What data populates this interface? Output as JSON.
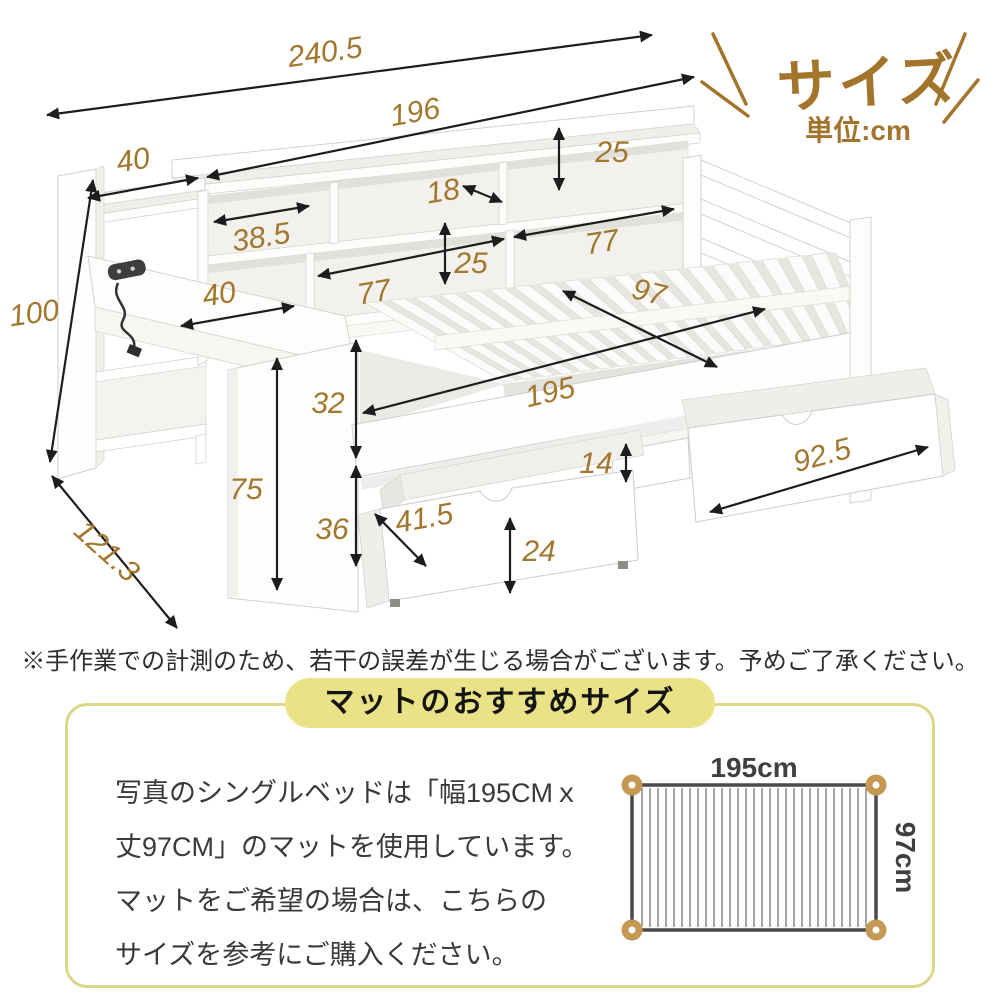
{
  "title": {
    "main": "サイズ",
    "unit": "単位:cm"
  },
  "disclaimer": "※手作業での計測のため、若干の誤差が生じる場合がございます。予めご了承ください。",
  "mat_box": {
    "header": "マットのおすすめサイズ",
    "lines": [
      "写真のシングルベッドは「幅195CMｘ",
      "丈97CM」のマットを使用しています。",
      "マットをご希望の場合は、こちらの",
      "サイズを参考にご購入ください。"
    ],
    "mat": {
      "width_label": "195cm",
      "height_label": "97cm"
    }
  },
  "dimensions": [
    {
      "value": "240.5",
      "lx": 325,
      "ly": 52,
      "rot": -8,
      "x1": 47,
      "y1": 115,
      "x2": 652,
      "y2": 35
    },
    {
      "value": "196",
      "lx": 415,
      "ly": 112,
      "rot": -10,
      "x1": 207,
      "y1": 177,
      "x2": 694,
      "y2": 77
    },
    {
      "value": "40",
      "lx": 133,
      "ly": 160,
      "rot": -9,
      "x1": 88,
      "y1": 198,
      "x2": 198,
      "y2": 178
    },
    {
      "value": "25",
      "lx": 612,
      "ly": 152,
      "rot": 0,
      "x1": 559,
      "y1": 128,
      "x2": 559,
      "y2": 190
    },
    {
      "value": "18",
      "lx": 443,
      "ly": 191,
      "rot": -9,
      "x1": 463,
      "y1": 186,
      "x2": 502,
      "y2": 202
    },
    {
      "value": "38.5",
      "lx": 261,
      "ly": 237,
      "rot": -9,
      "x1": 214,
      "y1": 222,
      "x2": 309,
      "y2": 206
    },
    {
      "value": "25",
      "lx": 471,
      "ly": 263,
      "rot": 0,
      "x1": 445,
      "y1": 223,
      "x2": 445,
      "y2": 284
    },
    {
      "value": "77",
      "lx": 374,
      "ly": 292,
      "rot": -10,
      "x1": 318,
      "y1": 276,
      "x2": 504,
      "y2": 239
    },
    {
      "value": "77",
      "lx": 602,
      "ly": 242,
      "rot": -9,
      "x1": 514,
      "y1": 237,
      "x2": 674,
      "y2": 209
    },
    {
      "value": "97",
      "lx": 649,
      "ly": 292,
      "rot": 14,
      "x1": 563,
      "y1": 291,
      "x2": 717,
      "y2": 367
    },
    {
      "value": "195",
      "lx": 550,
      "ly": 392,
      "rot": -13,
      "x1": 363,
      "y1": 413,
      "x2": 765,
      "y2": 309
    },
    {
      "value": "40",
      "lx": 219,
      "ly": 294,
      "rot": -9,
      "x1": 181,
      "y1": 326,
      "x2": 294,
      "y2": 306
    },
    {
      "value": "100",
      "lx": 34,
      "ly": 313,
      "rot": -8,
      "x1": 93,
      "y1": 180,
      "x2": 50,
      "y2": 462
    },
    {
      "value": "121.3",
      "lx": 107,
      "ly": 551,
      "rot": 42,
      "x1": 52,
      "y1": 476,
      "x2": 177,
      "y2": 628
    },
    {
      "value": "32",
      "lx": 328,
      "ly": 403,
      "rot": 0,
      "x1": 356,
      "y1": 340,
      "x2": 356,
      "y2": 458
    },
    {
      "value": "75",
      "lx": 246,
      "ly": 489,
      "rot": 0,
      "x1": 277,
      "y1": 358,
      "x2": 277,
      "y2": 590
    },
    {
      "value": "36",
      "lx": 332,
      "ly": 529,
      "rot": 0,
      "x1": 356,
      "y1": 466,
      "x2": 356,
      "y2": 566
    },
    {
      "value": "14",
      "lx": 596,
      "ly": 463,
      "rot": 0,
      "x1": 626,
      "y1": 444,
      "x2": 626,
      "y2": 482
    },
    {
      "value": "92.5",
      "lx": 822,
      "ly": 455,
      "rot": -15,
      "x1": 710,
      "y1": 512,
      "x2": 928,
      "y2": 447
    },
    {
      "value": "41.5",
      "lx": 424,
      "ly": 518,
      "rot": -10,
      "x1": 375,
      "y1": 514,
      "x2": 426,
      "y2": 566
    },
    {
      "value": "24",
      "lx": 539,
      "ly": 551,
      "rot": 0,
      "x1": 510,
      "y1": 518,
      "x2": 510,
      "y2": 593
    }
  ],
  "colors": {
    "dimension_text": "#a1772e",
    "title_brown": "#a3742c",
    "arrow": "#1d1d1d",
    "pill_yellow": "#e9e287",
    "box_border": "#ddd68a",
    "mat_corner": "#c59853",
    "mat_border": "#4a4a4a",
    "mat_stripe": "#a5a5a5"
  }
}
